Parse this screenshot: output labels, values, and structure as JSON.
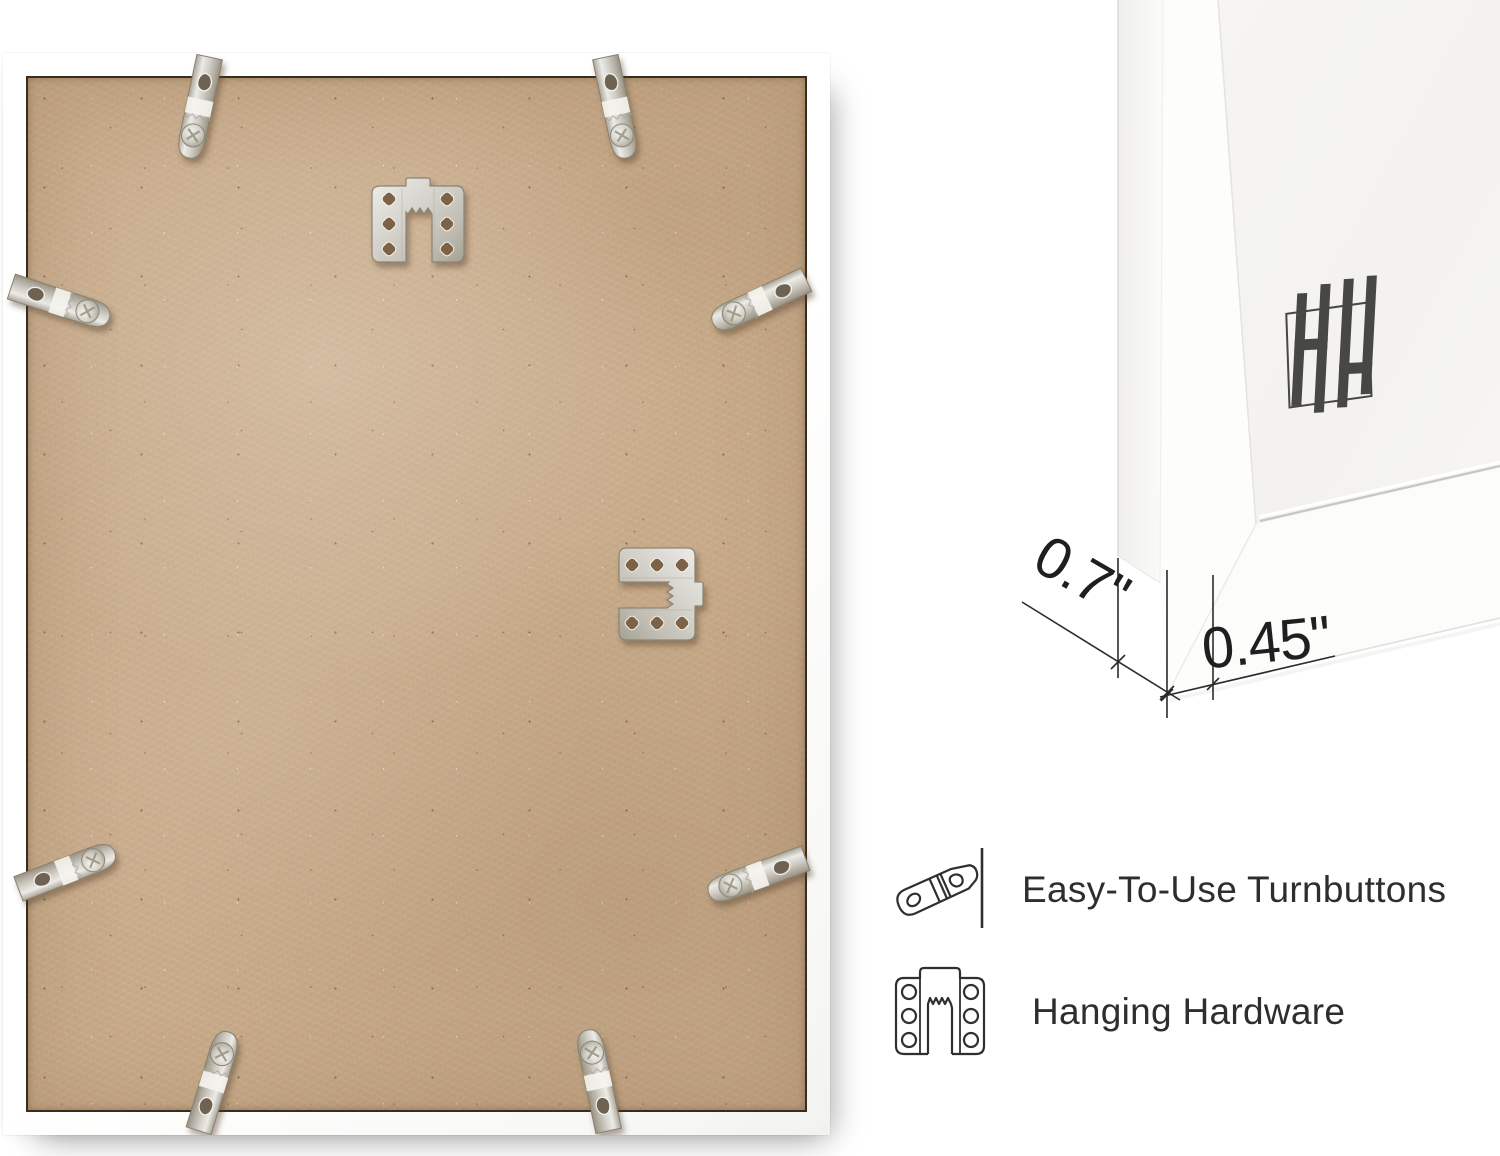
{
  "product_view": {
    "back_photo": {
      "description": "frame-back-with-hardware-photo",
      "board_color": "#c7aa89",
      "frame_color": "#ffffff",
      "turnbutton_count": 8,
      "hanger_count": 2
    },
    "corner_photo": {
      "logo_monogram": "HH",
      "dimensions": {
        "frame_face_width": "0.7\"",
        "frame_depth": "0.45\""
      },
      "annotation_color": "#222222",
      "background_color": "#f4f3f1"
    },
    "features": [
      {
        "icon": "turnbutton-icon",
        "label": "Easy-To-Use Turnbuttons"
      },
      {
        "icon": "hanging-hardware-icon",
        "label": "Hanging Hardware"
      }
    ],
    "colors": {
      "metal": "#d6d4ce",
      "label_text": "#2e2e2e",
      "logo": "#474744"
    }
  }
}
